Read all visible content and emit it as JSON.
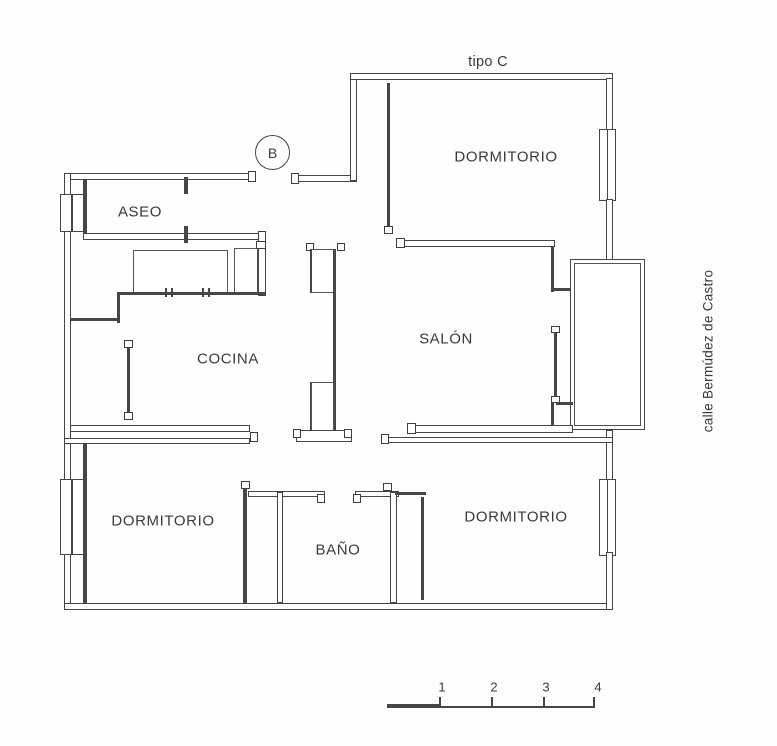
{
  "plan": {
    "title": "tipo C",
    "stair_label": "B",
    "street_label": "calle Bermúdez de Castro",
    "rooms": [
      {
        "id": "aseo",
        "label": "ASEO"
      },
      {
        "id": "dormitorio-top",
        "label": "DORMITORIO"
      },
      {
        "id": "cocina",
        "label": "COCINA"
      },
      {
        "id": "salon",
        "label": "SALÓN"
      },
      {
        "id": "dormitorio-left",
        "label": "DORMITORIO"
      },
      {
        "id": "bano",
        "label": "BAÑO"
      },
      {
        "id": "dormitorio-right",
        "label": "DORMITORIO"
      }
    ],
    "scale_bar": {
      "ticks": [
        "1",
        "2",
        "3",
        "4"
      ]
    },
    "colors": {
      "line": "#464646",
      "background": "#ffffff",
      "text": "#3a3a3a"
    }
  }
}
